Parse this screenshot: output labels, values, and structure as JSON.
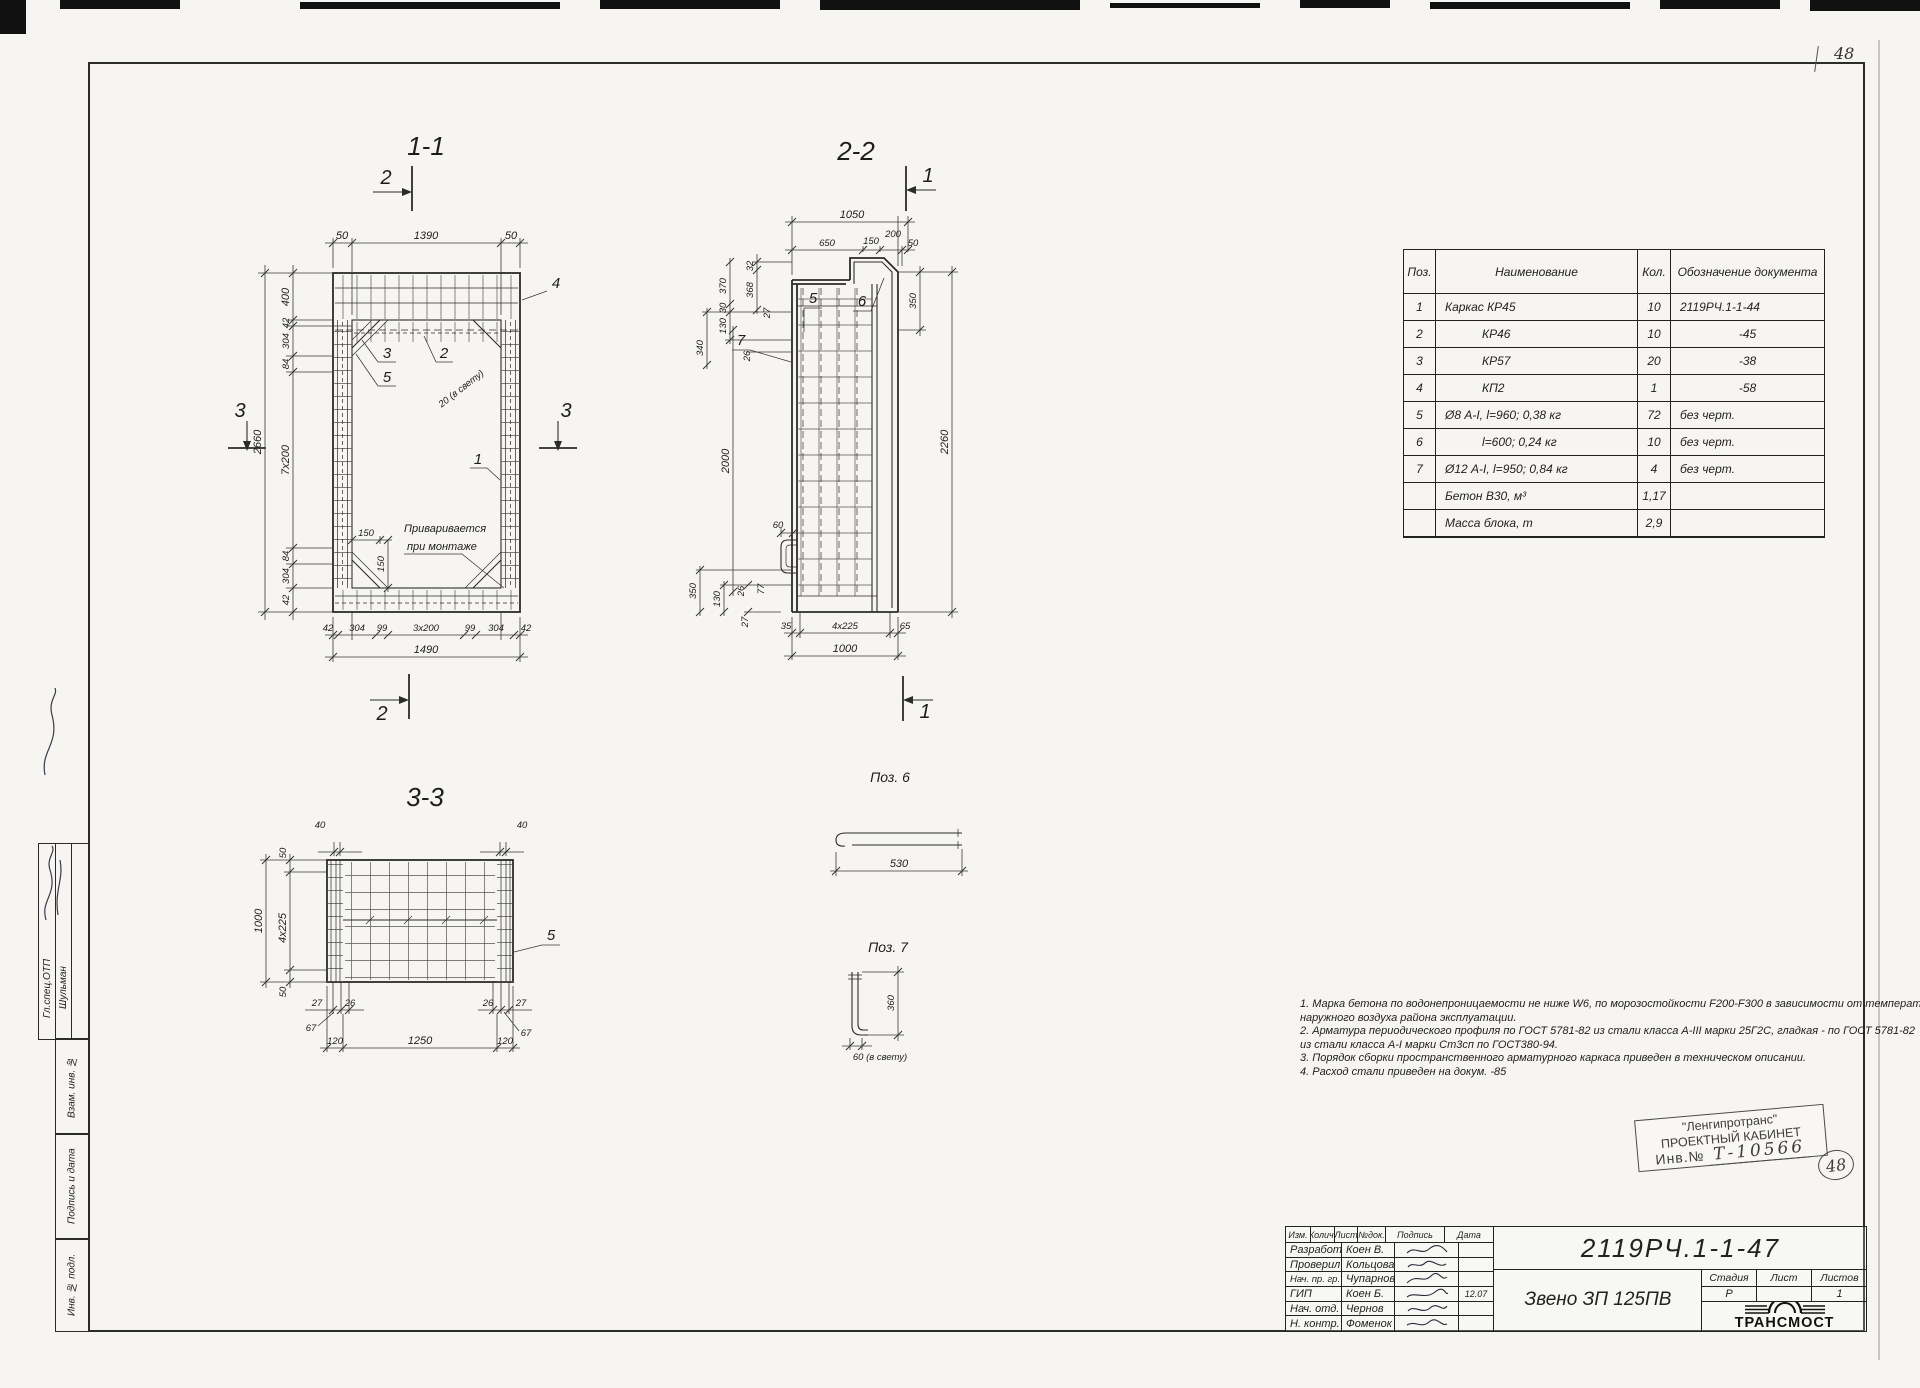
{
  "page": {
    "number": "48"
  },
  "colors": {
    "ink": "#2b2b2b",
    "paper": "#f6f5f1"
  },
  "s11": {
    "title": "1-1",
    "markers": {
      "top": "2",
      "bottom": "2",
      "left": "3",
      "right": "3"
    },
    "dims": {
      "top": [
        "50",
        "1390",
        "50"
      ],
      "left_upper": [
        "400",
        "42",
        "304",
        "84"
      ],
      "left_total": "2660",
      "left_mid": "7x200",
      "left_lower": [
        "84",
        "304",
        "42"
      ],
      "chamfer": [
        "150",
        "150"
      ],
      "bottom": [
        "42",
        "304",
        "99",
        "3x200",
        "99",
        "304",
        "42"
      ],
      "bottom_total": "1490"
    },
    "callouts": [
      "1",
      "2",
      "3",
      "4",
      "5"
    ],
    "clear_note": "20 (в свету)",
    "weld_note": [
      "Приваривается",
      "при монтаже"
    ]
  },
  "s22": {
    "title": "2-2",
    "markers": {
      "top": "1",
      "bottom": "1"
    },
    "dims": {
      "top_total": "1050",
      "top": [
        "650",
        "150",
        "200",
        "50"
      ],
      "left_upper": [
        "32",
        "368",
        "370",
        "30",
        "130",
        "340",
        "26",
        "27"
      ],
      "left_mid": "2000",
      "left_lower": [
        "350",
        "130",
        "26",
        "27",
        "77",
        "60"
      ],
      "right": [
        "350",
        "2260"
      ],
      "bottom": [
        "35",
        "4x225",
        "65"
      ],
      "bottom_total": "1000"
    },
    "callouts": [
      "5",
      "6",
      "7"
    ]
  },
  "s33": {
    "title": "3-3",
    "dims": {
      "top": [
        "40",
        "40"
      ],
      "left": [
        "50",
        "1000",
        "4x225",
        "50"
      ],
      "bottom_small": [
        "27",
        "26",
        "26",
        "27"
      ],
      "bottom_67": [
        "67",
        "67"
      ],
      "bottom": [
        "120",
        "1250",
        "120"
      ]
    },
    "callouts": [
      "5"
    ]
  },
  "pos6": {
    "label": "Поз. 6",
    "dim": "530"
  },
  "pos7": {
    "label": "Поз. 7",
    "dim_height": "360",
    "dim_clear": "60 (в свету)"
  },
  "spec_table": {
    "headers": [
      "Поз.",
      "Наименование",
      "Кол.",
      "Обозначение документа"
    ],
    "rows": [
      {
        "pos": "1",
        "name": "Каркас КР45",
        "qty": "10",
        "doc": "2119РЧ.1-1-44"
      },
      {
        "pos": "2",
        "name": "КР46",
        "qty": "10",
        "doc": "-45"
      },
      {
        "pos": "3",
        "name": "КР57",
        "qty": "20",
        "doc": "-38"
      },
      {
        "pos": "4",
        "name": "КП2",
        "qty": "1",
        "doc": "-58"
      },
      {
        "pos": "5",
        "name": "Ø8 А-I, l=960; 0,38 кг",
        "qty": "72",
        "doc": "без черт."
      },
      {
        "pos": "6",
        "name": "l=600; 0,24 кг",
        "qty": "10",
        "doc": "без черт."
      },
      {
        "pos": "7",
        "name": "Ø12 А-I, l=950; 0,84 кг",
        "qty": "4",
        "doc": "без черт."
      },
      {
        "pos": "",
        "name": "Бетон В30, м³",
        "qty": "1,17",
        "doc": ""
      },
      {
        "pos": "",
        "name": "Масса блока, т",
        "qty": "2,9",
        "doc": ""
      }
    ]
  },
  "notes": {
    "lines": [
      "1. Марка бетона по водонепроницаемости не ниже W6, по морозостойкости F200-F300 в зависимости от температуры",
      "наружного воздуха района эксплуатации.",
      "2. Арматура периодического профиля по ГОСТ 5781-82 из стали класса А-III марки 25Г2С, гладкая - по ГОСТ 5781-82",
      "из стали класса А-I марки Ст3сп по ГОСТ380-94.",
      "3. Порядок сборки пространственного арматурного каркаса приведен в техническом описании.",
      "4. Расход стали приведен на докум. -85"
    ]
  },
  "stamp": {
    "org": "\"Ленгипротранс\"",
    "dept": "ПРОЕКТНЫЙ КАБИНЕТ",
    "inv_label": "Инв.№",
    "inv_number": "Т-10566",
    "sheet_circle": "48"
  },
  "titleblock": {
    "header": [
      "Изм.",
      "Колич.",
      "Лист",
      "№док.",
      "Подпись",
      "Дата"
    ],
    "rows": [
      {
        "role": "Разработал",
        "name": "Коен В.",
        "date": ""
      },
      {
        "role": "Проверил",
        "name": "Кольцова",
        "date": ""
      },
      {
        "role": "Нач. пр. гр.",
        "name": "Чупарнова",
        "date": ""
      },
      {
        "role": "ГИП",
        "name": "Коен Б.",
        "date": "12.07"
      },
      {
        "role": "Нач. отд.",
        "name": "Чернов",
        "date": ""
      },
      {
        "role": "Н. контр.",
        "name": "Фоменок",
        "date": ""
      }
    ],
    "doc_number": "2119РЧ.1-1-47",
    "doc_name": "Звено ЗП 125ПВ",
    "stage_label": "Стадия",
    "sheet_label": "Лист",
    "sheets_label": "Листов",
    "stage": "Р",
    "sheet": "",
    "sheets": "1",
    "logo": "ТРАНСМОСТ"
  },
  "sidebar": {
    "approver_role": "Гл.спец.ОТП",
    "approver_name": "Шульман",
    "labels": [
      "Взам. инв. №",
      "Подпись и дата",
      "Инв. № подл."
    ]
  }
}
